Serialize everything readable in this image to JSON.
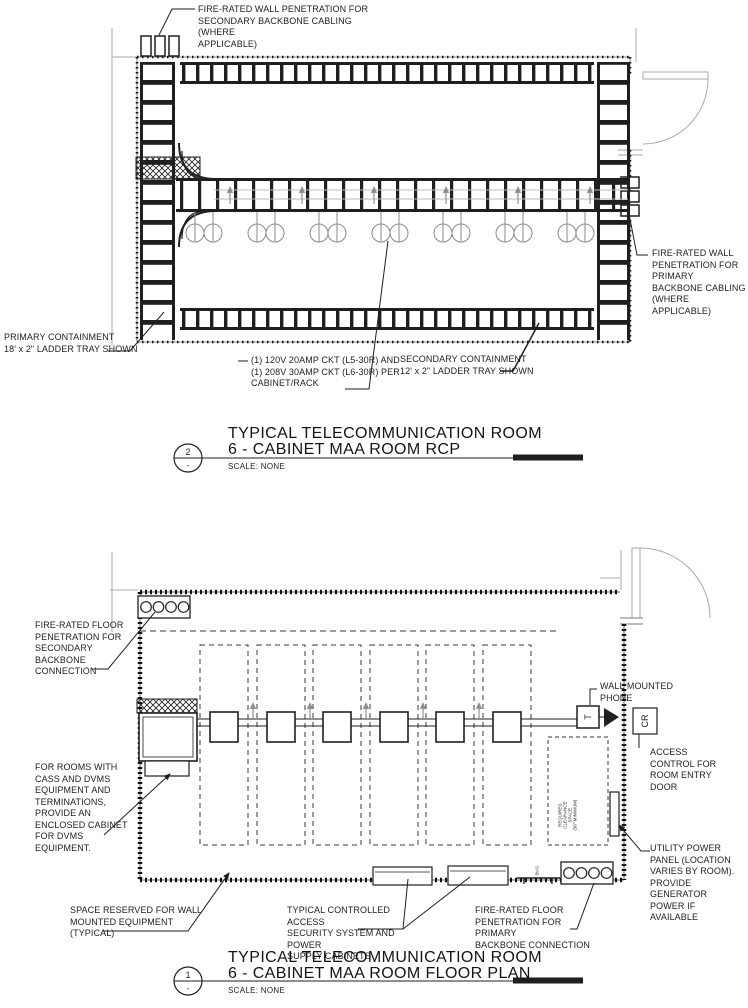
{
  "colors": {
    "ink": "#1f1f1f",
    "light_line": "#a9a9a9",
    "fixture_gray": "#8a8a8a",
    "arrow_gray": "#909090"
  },
  "rcp": {
    "annotations": {
      "wall_pen_secondary": "FIRE-RATED WALL PENETRATION FOR\nSECONDARY BACKBONE CABLING (WHERE\nAPPLICABLE)",
      "wall_pen_primary": "FIRE-RATED WALL\nPENETRATION FOR\nPRIMARY\nBACKBONE CABLING\n(WHERE\nAPPLICABLE)",
      "primary_containment": "PRIMARY CONTAINMENT\n18' x 2\" LADDER TRAY SHOWN",
      "circuit": "(1) 120V 20AMP CKT  (L5-30R)  AND\n(1) 208V 30AMP CKT (L6-30R) PER\nCABINET/RACK",
      "secondary_containment": "SECONDARY CONTAINMENT\n12' x 2\" LADDER TRAY SHOWN"
    },
    "title": {
      "detail_number": "2",
      "detail_sub": "-",
      "line1": "TYPICAL TELECOMMUNICATION ROOM",
      "line2": "6 - CABINET MAA ROOM RCP",
      "scale": "SCALE: NONE"
    }
  },
  "floor": {
    "annotations": {
      "floor_pen_secondary": "FIRE-RATED FLOOR\nPENETRATION FOR\nSECONDARY\nBACKBONE\nCONNECTION",
      "dvms_note": "FOR ROOMS WITH\nCASS AND DVMS\nEQUIPMENT AND\nTERMINATIONS,\nPROVIDE AN\nENCLOSED CABINET\nFOR DVMS EQUIPMENT.",
      "wall_phone": "WALL MOUNTED\nPHONE",
      "card_reader": "CR",
      "phone_t": "T",
      "access_control": "ACCESS\nCONTROL FOR\nROOM ENTRY\nDOOR",
      "clearance": "REQUIRED\nCLEARANCE\nSPACE\n(36\" MINIMUM)",
      "utility_panel": "UTILITY POWER\nPANEL (LOCATION\nVARIES BY ROOM).\nPROVIDE\nGENERATOR\nPOWER IF\nAVAILABLE",
      "space_reserved": "SPACE RESERVED FOR WALL\nMOUNTED EQUIPMENT\n(TYPICAL)",
      "security_cabinets": "TYPICAL CONTROLLED ACCESS\nSECURITY SYSTEM AND POWER\nSUPPLY CABINETS",
      "floor_pen_primary": "FIRE-RATED FLOOR\nPENETRATION FOR PRIMARY\nBACKBONE CONNECTION",
      "bas_label": "BAS"
    },
    "title": {
      "detail_number": "1",
      "detail_sub": "-",
      "line1": "TYPICAL TELECOMMUNICATION ROOM",
      "line2": "6 - CABINET MAA ROOM FLOOR PLAN",
      "scale": "SCALE: NONE"
    }
  }
}
